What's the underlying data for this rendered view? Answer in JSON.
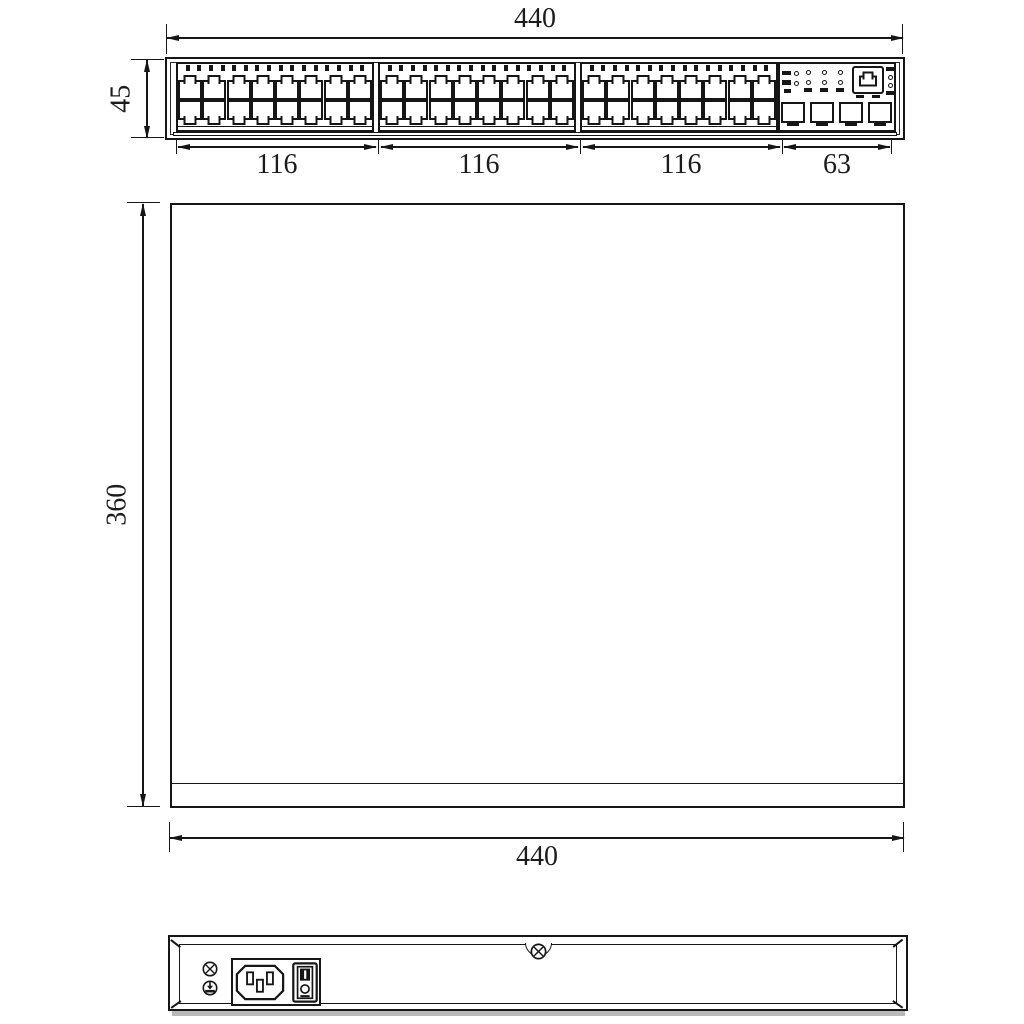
{
  "page": {
    "background": "#ffffff",
    "line_color": "#161616"
  },
  "labels": {
    "front_width_top": "440",
    "front_height": "45",
    "front_seg_1": "116",
    "front_seg_2": "116",
    "front_seg_3": "116",
    "front_seg_4": "63",
    "top_depth": "360",
    "top_width_bottom": "440"
  },
  "front_panel": {
    "port_blocks": 3,
    "columns_per_block": 8,
    "port_rows_per_block": 2,
    "led_marks_per_block": 16,
    "status_led_columns": 4,
    "sfp_cages": 4,
    "console_port_icon": "rj45-console-icon"
  },
  "rear_panel": {
    "center_icon": "screw-icon",
    "left_icons": [
      "screw-icon",
      "ground-icon"
    ],
    "module_icons": [
      "ac-inlet-icon",
      "power-switch-icon"
    ]
  }
}
